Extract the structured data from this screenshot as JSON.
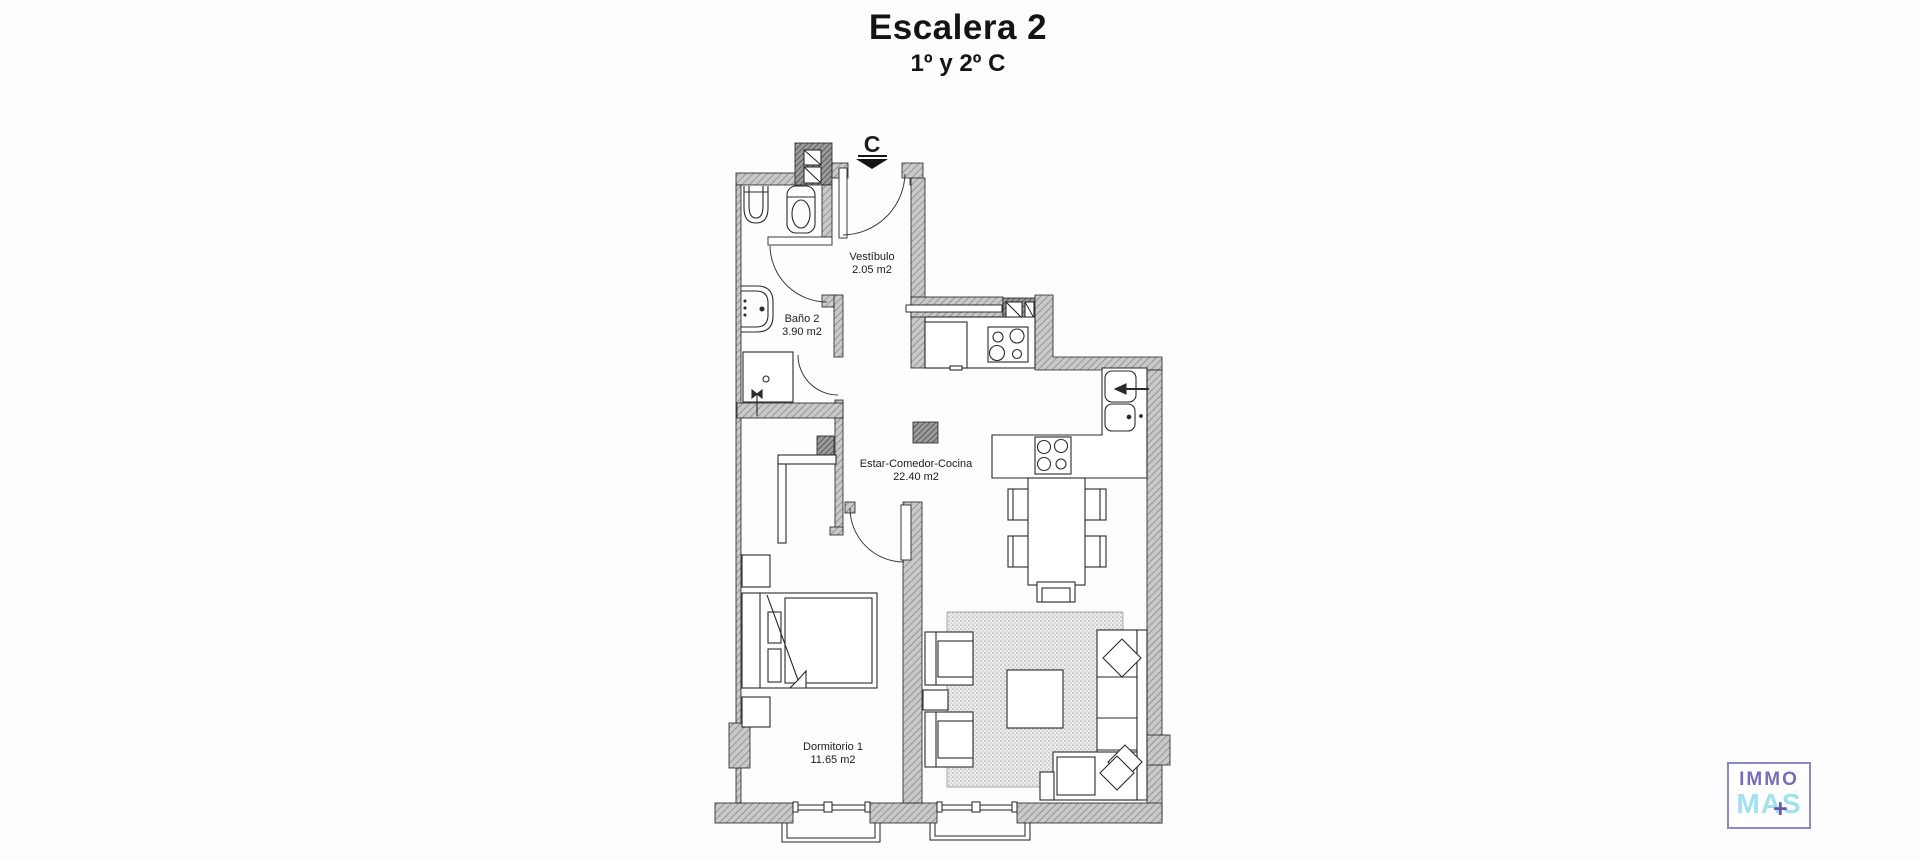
{
  "header": {
    "title": "Escalera 2",
    "subtitle": "1º y 2º C"
  },
  "plan": {
    "entrance": {
      "marker": "C"
    },
    "rooms": [
      {
        "id": "vestibulo",
        "name": "Vestíbulo",
        "area": "2.05 m2"
      },
      {
        "id": "bano2",
        "name": "Baño 2",
        "area": "3.90 m2"
      },
      {
        "id": "estar",
        "name": "Estar-Comedor-Cocina",
        "area": "22.40 m2"
      },
      {
        "id": "dormitorio1",
        "name": "Dormitorio 1",
        "area": "11.65 m2"
      }
    ]
  },
  "logo": {
    "top": "IMMO",
    "bottom": "MAS",
    "plus": "+"
  },
  "colors": {
    "wall_fill": "#c9c9c9",
    "wall_hatch": "#7f7f7f",
    "shaft_fill": "#9b9b9b",
    "shaft_hatch": "#404040",
    "line": "#2a2a2a",
    "rug_bg": "#ededed",
    "rug_dot": "#a8a8a8",
    "logo_border": "#8d89c7",
    "logo_immo": "#7a6bbe",
    "logo_mas": "#9fe2ee",
    "logo_plus": "#6656ab"
  }
}
